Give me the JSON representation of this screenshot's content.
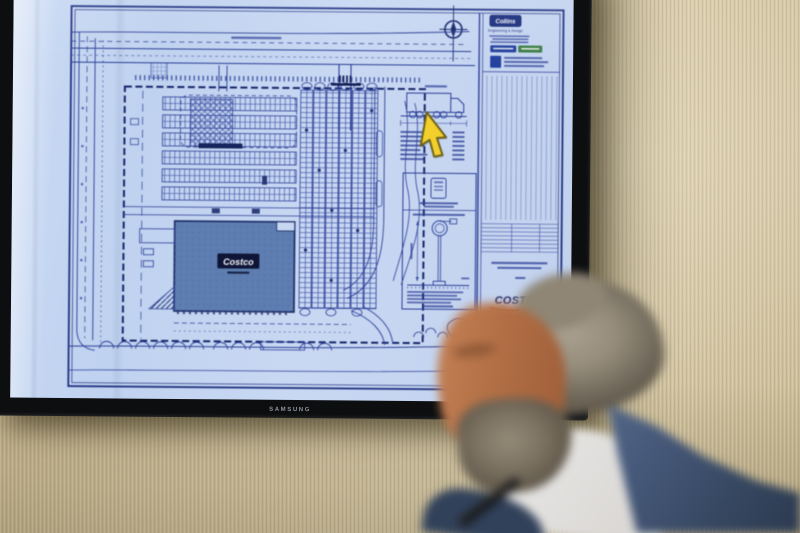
{
  "tv": {
    "brand_label": "SAMSUNG"
  },
  "site_plan": {
    "building_label": "Costco",
    "title_block": {
      "firm_name": "Collins",
      "firm_tagline": "Engineering & Design",
      "client_logo": "COSTCO"
    }
  },
  "colors": {
    "screen_blue": "#c5d5f0",
    "plan_line_blue": "#2b3d95",
    "plan_line_dark": "#16266b",
    "building_fill": "#5d7db1",
    "cursor_yellow": "#f2cf2b",
    "costco_navy": "#1b2d74",
    "costco_red": "#c0392b",
    "wall_tan": "#cfc09c",
    "blazer_navy": "#3c4f6b",
    "bezel_black": "#0d0e10"
  }
}
